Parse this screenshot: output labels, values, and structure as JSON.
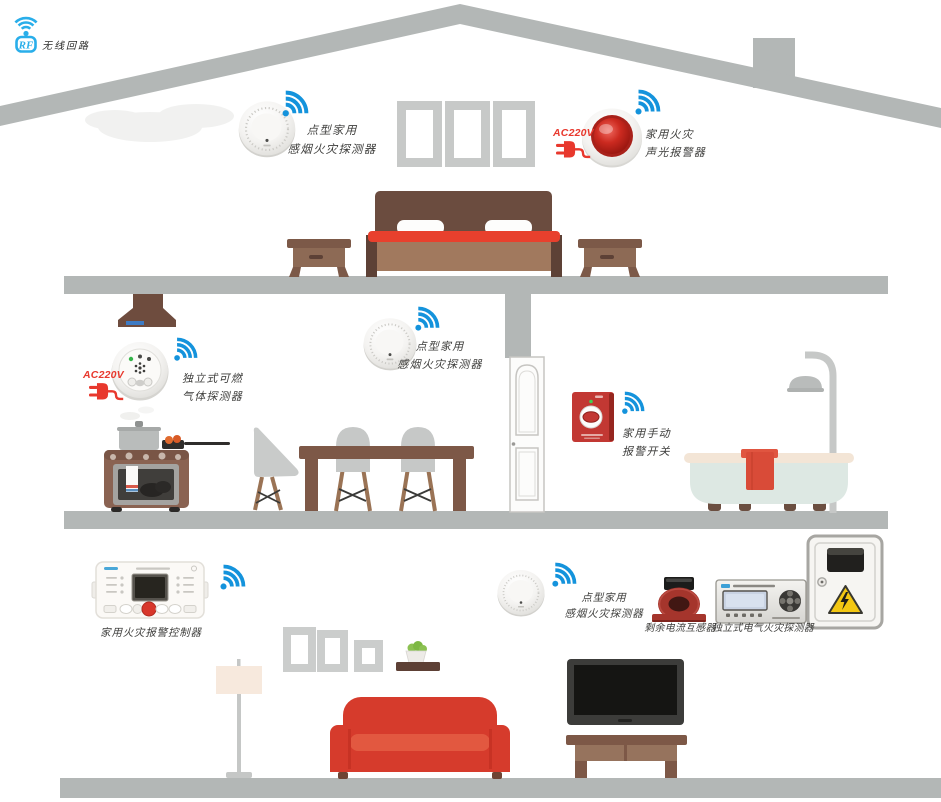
{
  "logo": {
    "rf": "RF",
    "caption": "无线回路"
  },
  "devices": {
    "smoke_attic": {
      "line1": "点型家用",
      "line2": "感烟火灾探测器"
    },
    "sound_light_alarm": {
      "power": "AC220V",
      "line1": "家用火灾",
      "line2": "声光报警器"
    },
    "gas_detector": {
      "power": "AC220V",
      "line1": "独立式可燃",
      "line2": "气体探测器"
    },
    "smoke_mid": {
      "line1": "点型家用",
      "line2": "感烟火灾探测器"
    },
    "manual_switch": {
      "line1": "家用手动",
      "line2": "报警开关"
    },
    "control_panel": {
      "label": "家用火灾报警控制器"
    },
    "smoke_living": {
      "line1": "点型家用",
      "line2": "感烟火灾探测器"
    },
    "residual_current_transformer": {
      "label": "剩余电流互感器"
    },
    "electrical_fire_detector": {
      "label": "独立式电气火灾探测器"
    }
  },
  "colors": {
    "wifi_blue": "#1493dc",
    "logo_blue": "#29aeea",
    "power_red": "#e8382d",
    "structure_gray": "#b3b7b6",
    "sofa_red": "#d63b2c",
    "blanket_red": "#e8402d",
    "alarm_red": "#c23833",
    "warning_yellow": "#f3c712"
  }
}
